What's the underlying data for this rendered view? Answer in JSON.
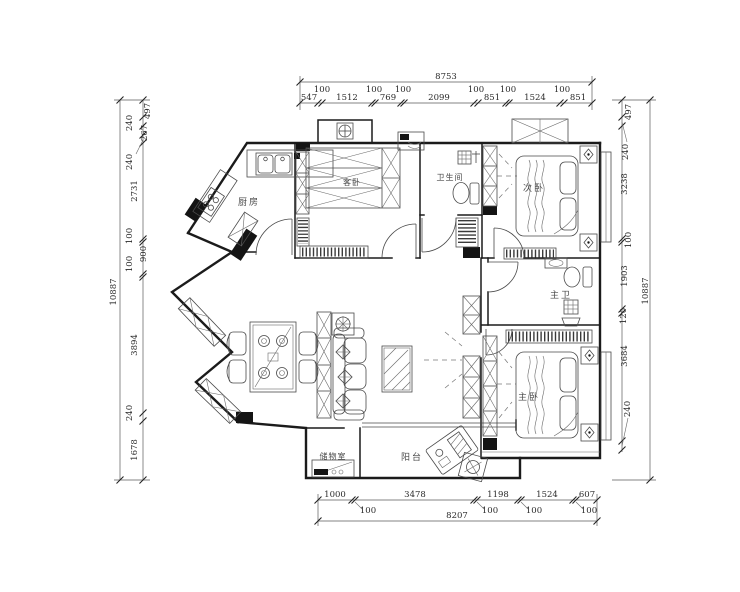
{
  "drawing_title": "apartment-floor-plan",
  "rooms": {
    "kitchen": "厨房",
    "guest_bedroom": "客卧",
    "bathroom": "卫生间",
    "second_bedroom": "次卧",
    "master_bathroom": "主卫",
    "master_bedroom": "主卧",
    "storage": "储物室",
    "balcony": "阳台"
  },
  "dims": {
    "top": {
      "total": "8753",
      "segments": [
        "547",
        "100",
        "1512",
        "100",
        "769",
        "100",
        "2099",
        "100",
        "851",
        "100",
        "1524",
        "100",
        "851"
      ]
    },
    "bottom": {
      "total": "8207",
      "segments": [
        "1000",
        "100",
        "3478",
        "100",
        "1198",
        "100",
        "1524",
        "100",
        "607"
      ]
    },
    "left": {
      "total": "10887",
      "segments": [
        "497",
        "240",
        "267",
        "240",
        "2731",
        "100",
        "900",
        "100",
        "3894",
        "240",
        "1678"
      ]
    },
    "right": {
      "total": "10887",
      "segments": [
        "497",
        "240",
        "3238",
        "100",
        "1903",
        "120",
        "3684",
        "240"
      ]
    }
  },
  "colors": {
    "line": "#1b1b1b",
    "background": "#ffffff"
  }
}
